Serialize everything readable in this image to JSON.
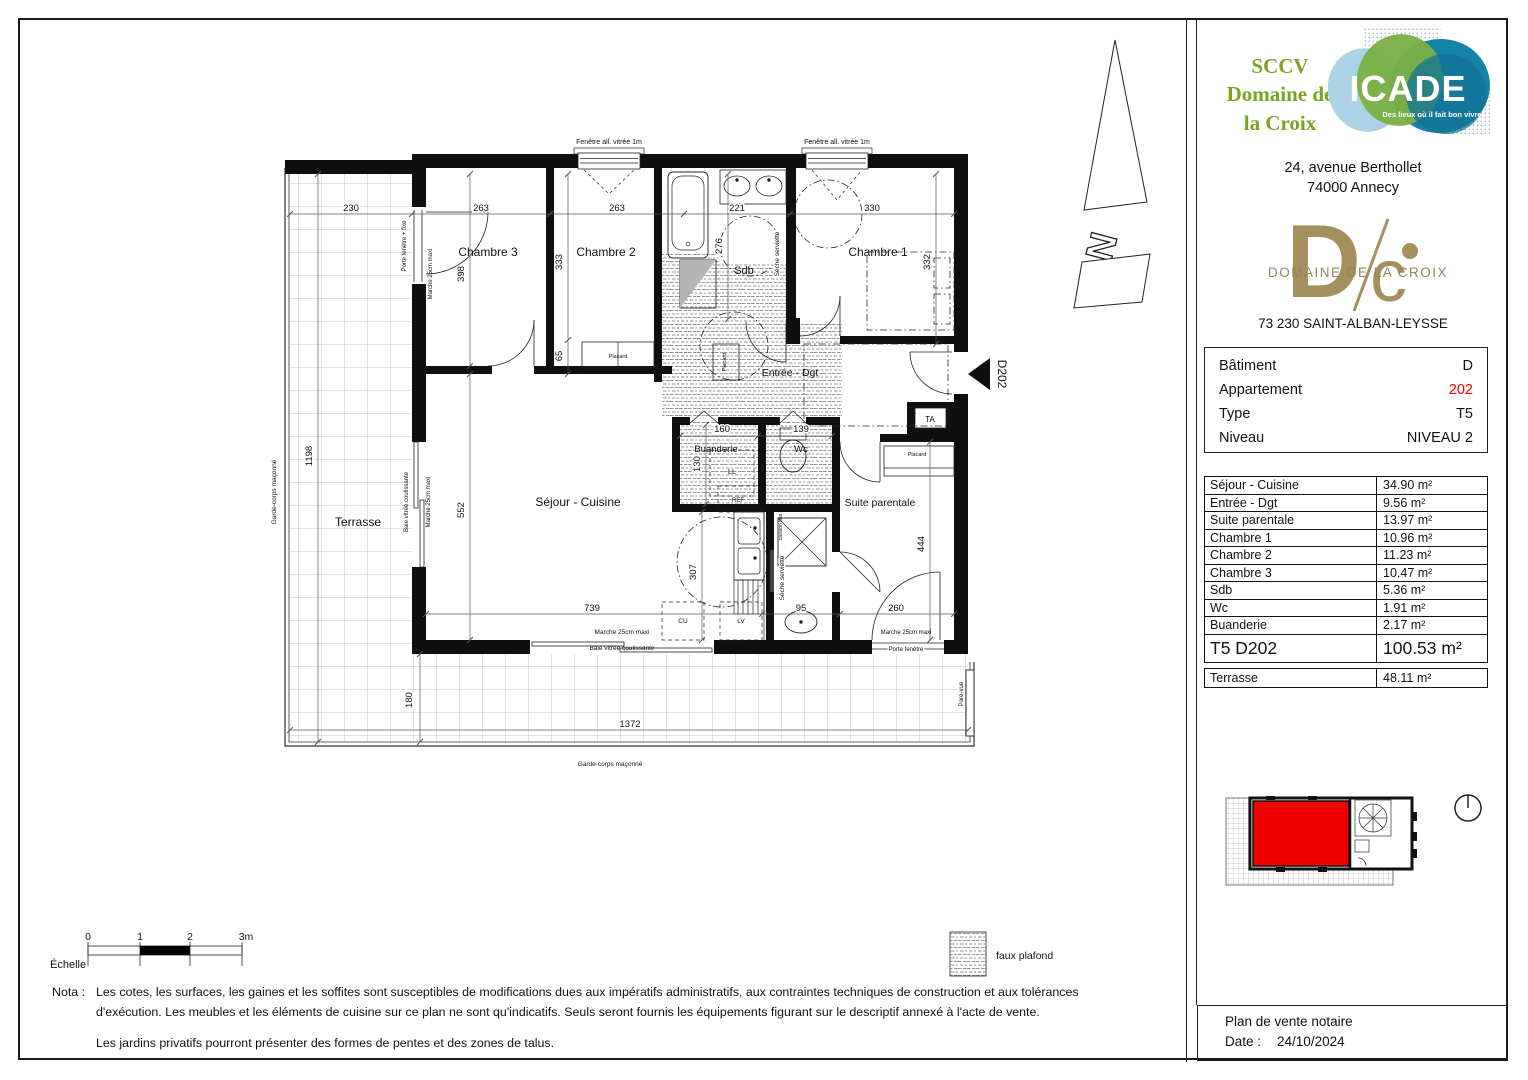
{
  "header": {
    "developer": {
      "line1": "SCCV",
      "line2": "Domaine de",
      "line3": "la Croix",
      "color": "#79a320"
    },
    "icade": {
      "name": "ICADE",
      "tagline": "Des lieux où il fait bon vivre",
      "colors": {
        "light_blue": "#abd3e5",
        "green": "#79af43",
        "teal": "#1583a8"
      }
    },
    "address": {
      "line1": "24, avenue Berthollet",
      "line2": "74000 Annecy"
    },
    "brand": {
      "mono_d": "D",
      "mono_c": "c",
      "wordmark": "DOMAINE DE LA CROIX",
      "color": "#a3905e",
      "city": "73 230 SAINT-ALBAN-LEYSSE"
    }
  },
  "unit_info": {
    "rows": [
      {
        "label": "Bâtiment",
        "value": "D",
        "color": "#111111"
      },
      {
        "label": "Appartement",
        "value": "202",
        "color": "#f00000"
      },
      {
        "label": "Type",
        "value": "T5",
        "color": "#111111"
      },
      {
        "label": "Niveau",
        "value": "NIVEAU 2",
        "color": "#111111"
      }
    ]
  },
  "areas": {
    "rows": [
      {
        "label": "Séjour - Cuisine",
        "value": "34.90 m²"
      },
      {
        "label": "Entrée - Dgt",
        "value": "9.56 m²"
      },
      {
        "label": "Suite parentale",
        "value": "13.97 m²"
      },
      {
        "label": "Chambre 1",
        "value": "10.96 m²"
      },
      {
        "label": "Chambre 2",
        "value": "11.23 m²"
      },
      {
        "label": "Chambre 3",
        "value": "10.47 m²"
      },
      {
        "label": "Sdb",
        "value": "5.36 m²"
      },
      {
        "label": "Wc",
        "value": "1.91 m²"
      },
      {
        "label": "Buanderie",
        "value": "2.17 m²"
      }
    ],
    "total": {
      "label": "T5 D202",
      "value": "100.53 m²"
    },
    "terrace": {
      "label": "Terrasse",
      "value": "48.11 m²"
    }
  },
  "plan": {
    "north_letter": "N",
    "texts": [
      {
        "t": "Chambre 3",
        "x": 466,
        "y": 234,
        "s": 12,
        "n": "room-label-chambre3"
      },
      {
        "t": "Chambre 2",
        "x": 584,
        "y": 234,
        "s": 12,
        "n": "room-label-chambre2"
      },
      {
        "t": "Chambre 1",
        "x": 856,
        "y": 234,
        "s": 12,
        "n": "room-label-chambre1"
      },
      {
        "t": "Sdb",
        "x": 722,
        "y": 252,
        "s": 11,
        "n": "room-label-sdb"
      },
      {
        "t": "Entrée - Dgt",
        "x": 768,
        "y": 354,
        "s": 10.5,
        "n": "room-label-entree"
      },
      {
        "t": "Buanderie",
        "x": 694,
        "y": 430,
        "s": 9.5,
        "n": "room-label-buanderie"
      },
      {
        "t": "Wc",
        "x": 779,
        "y": 430,
        "s": 9.5,
        "n": "room-label-wc"
      },
      {
        "t": "Séjour - Cuisine",
        "x": 556,
        "y": 484,
        "s": 12,
        "n": "room-label-sejour"
      },
      {
        "t": "Suite parentale",
        "x": 858,
        "y": 484,
        "s": 10.5,
        "n": "room-label-suite"
      },
      {
        "t": "Terrasse",
        "x": 336,
        "y": 504,
        "s": 12,
        "n": "room-label-terrasse"
      },
      {
        "t": "230",
        "x": 329,
        "y": 189,
        "s": 9.5,
        "halo": true,
        "n": "dim"
      },
      {
        "t": "263",
        "x": 459,
        "y": 189,
        "s": 9.5,
        "halo": true,
        "n": "dim"
      },
      {
        "t": "263",
        "x": 595,
        "y": 189,
        "s": 9.5,
        "halo": true,
        "n": "dim"
      },
      {
        "t": "221",
        "x": 715,
        "y": 189,
        "s": 9.5,
        "halo": true,
        "n": "dim"
      },
      {
        "t": "330",
        "x": 850,
        "y": 189,
        "s": 9.5,
        "halo": true,
        "n": "dim"
      },
      {
        "t": "398",
        "x": 442,
        "y": 252,
        "s": 9.5,
        "r": -90,
        "halo": true,
        "n": "dim"
      },
      {
        "t": "333",
        "x": 540,
        "y": 240,
        "s": 9.5,
        "r": -90,
        "halo": true,
        "n": "dim"
      },
      {
        "t": "65",
        "x": 540,
        "y": 334,
        "s": 9.5,
        "r": -90,
        "halo": true,
        "n": "dim"
      },
      {
        "t": "276",
        "x": 700,
        "y": 224,
        "s": 9.5,
        "r": -90,
        "halo": true,
        "n": "dim"
      },
      {
        "t": "332",
        "x": 908,
        "y": 240,
        "s": 9.5,
        "r": -90,
        "halo": true,
        "n": "dim"
      },
      {
        "t": "1198",
        "x": 290,
        "y": 434,
        "s": 9.5,
        "r": -90,
        "halo": true,
        "n": "dim"
      },
      {
        "t": "552",
        "x": 442,
        "y": 488,
        "s": 9.5,
        "r": -90,
        "halo": true,
        "n": "dim"
      },
      {
        "t": "739",
        "x": 570,
        "y": 589,
        "s": 9.5,
        "halo": true,
        "n": "dim"
      },
      {
        "t": "307",
        "x": 674,
        "y": 550,
        "s": 9.5,
        "r": -90,
        "halo": true,
        "n": "dim"
      },
      {
        "t": "160",
        "x": 700,
        "y": 410,
        "s": 9.5,
        "halo": true,
        "n": "dim"
      },
      {
        "t": "139",
        "x": 779,
        "y": 410,
        "s": 9.5,
        "halo": true,
        "n": "dim"
      },
      {
        "t": "130",
        "x": 678,
        "y": 442,
        "s": 9.5,
        "r": -90,
        "halo": true,
        "n": "dim"
      },
      {
        "t": "95",
        "x": 779,
        "y": 589,
        "s": 9.5,
        "halo": true,
        "n": "dim"
      },
      {
        "t": "260",
        "x": 874,
        "y": 589,
        "s": 9.5,
        "halo": true,
        "n": "dim"
      },
      {
        "t": "444",
        "x": 902,
        "y": 522,
        "s": 9.5,
        "r": -90,
        "halo": true,
        "n": "dim"
      },
      {
        "t": "180",
        "x": 390,
        "y": 678,
        "s": 9.5,
        "r": -90,
        "halo": true,
        "n": "dim"
      },
      {
        "t": "1372",
        "x": 608,
        "y": 705,
        "s": 9.5,
        "halo": true,
        "n": "dim"
      },
      {
        "t": "Fenêtre all. vitrée 1m",
        "x": 587,
        "y": 122,
        "s": 7,
        "n": "annotation-window"
      },
      {
        "t": "Fenêtre all. vitrée 1m",
        "x": 815,
        "y": 122,
        "s": 7,
        "n": "annotation-window"
      },
      {
        "t": "Porte fenêtre + fixe",
        "x": 384,
        "y": 224,
        "s": 6,
        "r": -90,
        "n": "annotation"
      },
      {
        "t": "Marche 25cm maxi",
        "x": 410,
        "y": 252,
        "s": 6,
        "r": -90,
        "n": "annotation"
      },
      {
        "t": "Baie vitrée coulissante",
        "x": 386,
        "y": 480,
        "s": 6,
        "r": -90,
        "n": "annotation"
      },
      {
        "t": "Marche 25cm maxi",
        "x": 408,
        "y": 480,
        "s": 6,
        "r": -90,
        "n": "annotation"
      },
      {
        "t": "Marche 25cm maxi",
        "x": 600,
        "y": 612,
        "s": 6.5,
        "n": "annotation"
      },
      {
        "t": "Baie vitrée coulissante",
        "x": 600,
        "y": 628,
        "s": 6.5,
        "n": "annotation"
      },
      {
        "t": "Marche 25cm maxi",
        "x": 884,
        "y": 612,
        "s": 6,
        "n": "annotation"
      },
      {
        "t": "Porte fenêtre",
        "x": 884,
        "y": 629,
        "s": 6,
        "halo": true,
        "n": "annotation"
      },
      {
        "t": "Pare-vue",
        "x": 941,
        "y": 672,
        "s": 6,
        "r": -90,
        "n": "annotation"
      },
      {
        "t": "Garde-corps maçonné",
        "x": 254,
        "y": 470,
        "s": 6.5,
        "r": -90,
        "n": "annotation"
      },
      {
        "t": "Garde-corps maçonné",
        "x": 588,
        "y": 744,
        "s": 6.5,
        "n": "annotation"
      },
      {
        "t": "Sèche serviette",
        "x": 757,
        "y": 232,
        "s": 6.5,
        "r": -90,
        "halo": true,
        "n": "annotation"
      },
      {
        "t": "Sèche serviette",
        "x": 762,
        "y": 556,
        "s": 6.5,
        "r": -90,
        "halo": true,
        "n": "annotation"
      },
      {
        "t": "Placard",
        "x": 596,
        "y": 336,
        "s": 5.5,
        "n": "annotation-placard"
      },
      {
        "t": "Placard",
        "x": 704,
        "y": 340,
        "s": 5.5,
        "r": -90,
        "n": "annotation-placard"
      },
      {
        "t": "Placard",
        "x": 895,
        "y": 434,
        "s": 5.5,
        "n": "annotation-placard"
      },
      {
        "t": "TA",
        "x": 908,
        "y": 400,
        "s": 8,
        "n": "annotation-ta"
      },
      {
        "t": "REF",
        "x": 716,
        "y": 480,
        "s": 6,
        "n": "annotation-ref"
      },
      {
        "t": "LL",
        "x": 710,
        "y": 452,
        "s": 7.5,
        "n": "annotation-ll"
      },
      {
        "t": "CU",
        "x": 661,
        "y": 601,
        "s": 6.5,
        "n": "annotation-cu"
      },
      {
        "t": "LV",
        "x": 719,
        "y": 601,
        "s": 6.5,
        "n": "annotation-lv"
      },
      {
        "t": "caisson bas",
        "x": 760,
        "y": 505,
        "s": 5,
        "r": -90,
        "n": "annotation"
      },
      {
        "t": "D202",
        "x": 976,
        "y": 352,
        "s": 12,
        "r": 90,
        "n": "entrance-tag"
      },
      {
        "t": "Échelle",
        "x": 28,
        "y": 946,
        "s": 11,
        "a": "start",
        "n": "scale-label"
      },
      {
        "t": "0",
        "x": 66,
        "y": 918,
        "s": 10.5,
        "n": "scale-tick"
      },
      {
        "t": "1",
        "x": 118,
        "y": 918,
        "s": 10.5,
        "n": "scale-tick"
      },
      {
        "t": "2",
        "x": 168,
        "y": 918,
        "s": 10.5,
        "n": "scale-tick"
      },
      {
        "t": "3m",
        "x": 224,
        "y": 918,
        "s": 10.5,
        "n": "scale-tick"
      },
      {
        "t": "faux plafond",
        "x": 974,
        "y": 937,
        "s": 10.5,
        "a": "start",
        "n": "legend-label"
      }
    ]
  },
  "nota": {
    "label": "Nota :",
    "p1": "Les cotes, les surfaces, les gaines et les soffites sont susceptibles de modifications dues aux impératifs administratifs, aux contraintes techniques de construction et aux tolérances d'exécution. Les meubles et les éléments de cuisine sur ce plan ne sont qu'indicatifs. Seuls seront fournis les équipements figurant sur le descriptif annexé à l'acte de vente.",
    "p2": "Les jardins privatifs pourront présenter des formes de pentes et des zones de talus."
  },
  "footer": {
    "title": "Plan de vente notaire",
    "date_label": "Date :",
    "date": "24/10/2024"
  }
}
